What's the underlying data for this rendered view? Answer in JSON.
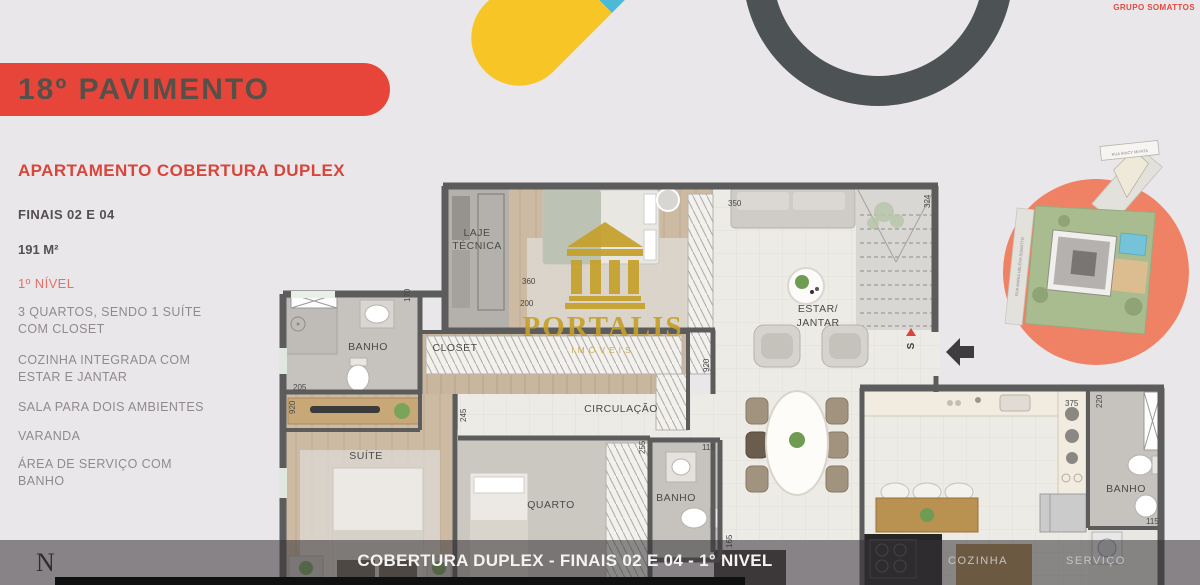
{
  "header": {
    "brand": "GRUPO SOMATTOS",
    "banner_title": "18º PAVIMENTO"
  },
  "info": {
    "title": "APARTAMENTO COBERTURA DUPLEX",
    "units": "FINAIS 02 E 04",
    "area": "191 M²",
    "level": "1º NÍVEL",
    "features": [
      "3 QUARTOS, SENDO 1 SUÍTE\nCOM CLOSET",
      "COZINHA INTEGRADA COM\nESTAR E JANTAR",
      "SALA PARA DOIS AMBIENTES",
      "VARANDA",
      "ÁREA DE SERVIÇO COM\nBANHO"
    ]
  },
  "floorplan": {
    "watermark": {
      "title": "PORTALIS",
      "subtitle": "IMÓVEIS"
    },
    "rooms": {
      "laje_line1": "LAJE",
      "laje_line2": "TÉCNICA",
      "banho_suite": "BANHO",
      "closet": "CLOSET",
      "suite": "SUÍTE",
      "quarto": "QUARTO",
      "circulacao": "CIRCULAÇÃO",
      "banho_social": "BANHO",
      "estar_line1": "ESTAR/",
      "estar_line2": "JANTAR",
      "cozinha": "COZINHA",
      "servico": "SERVIÇO",
      "banho_servico": "BANHO"
    },
    "dimensions": {
      "d360": "360",
      "d170": "170",
      "d200": "200",
      "d205": "205",
      "d920_left": "920",
      "d245": "245",
      "d255": "255",
      "d115_banho": "115",
      "d165": "165",
      "d350": "350",
      "d324": "324",
      "d920_estar": "920",
      "d375": "375",
      "d220": "220",
      "d115_servico": "115"
    },
    "stairs_label": "S"
  },
  "siteplan": {
    "street_diagonal": "RUA IRACY MIYATA",
    "street_vertical": "RUA MARIA HELENA SOMATTO"
  },
  "footer": {
    "caption": "COBERTURA DUPLEX - FINAIS 02 E 04 - 1° NIVEL",
    "compass": "N"
  }
}
